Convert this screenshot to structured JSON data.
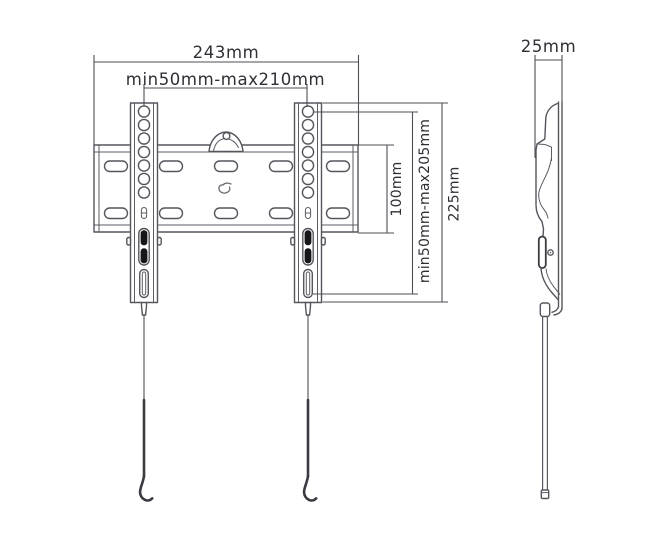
{
  "drawing": {
    "kind": "dimension-diagram",
    "front_view": {
      "labels": {
        "overall_width": "243mm",
        "hole_spacing_width": "min50mm-max210mm",
        "plate_height": "100mm",
        "hole_spacing_height": "min50mm-max205mm",
        "bracket_height": "225mm"
      }
    },
    "side_view": {
      "labels": {
        "depth": "25mm"
      }
    }
  },
  "colors": {
    "line": "#55555d",
    "dimension_line": "#4f4f57",
    "text": "#2f2f36",
    "lock_fill": "#17171b",
    "background": "#ffffff"
  }
}
